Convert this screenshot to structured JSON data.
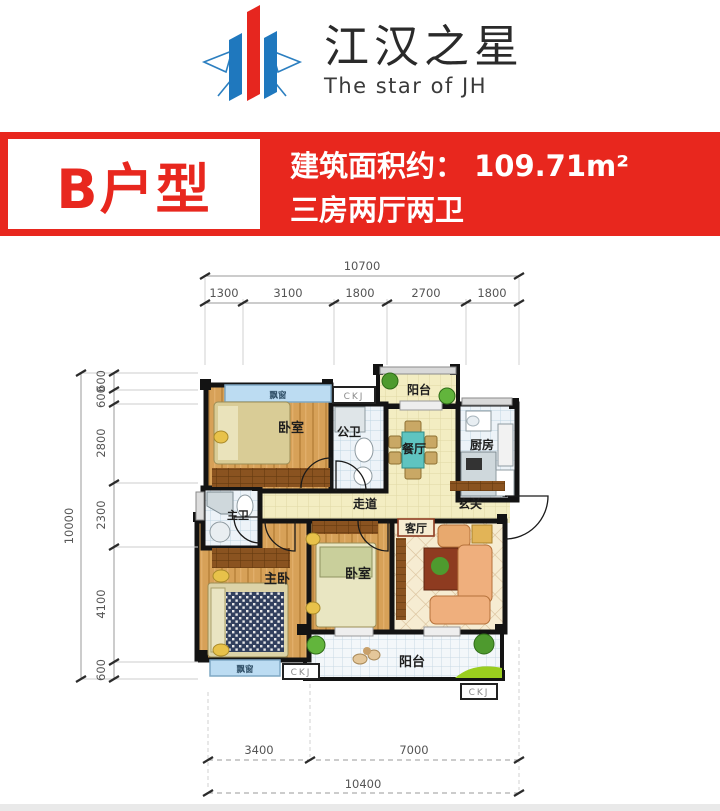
{
  "logo": {
    "name": "江汉之星",
    "subtitle": "The star of JH",
    "red": "#E6261F",
    "blue": "#1F78BE"
  },
  "banner": {
    "unit_label": "B户型",
    "area_text": "建筑面积约： 109.71m²",
    "layout_text": "三房两厅两卫",
    "bg_color": "#E8271E"
  },
  "plan": {
    "window_code": "CKJ",
    "rooms": {
      "balcony_top": "阳台",
      "bay_window_top": "飘窗",
      "bedroom_top": "卧室",
      "guest_bath": "公卫",
      "dining": "餐厅",
      "kitchen": "厨房",
      "foyer": "玄关",
      "corridor": "走道",
      "master_bath": "主卫",
      "master_bedroom": "主卧",
      "bedroom_bottom": "卧室",
      "living": "客厅",
      "balcony_bottom": "阳台",
      "bay_window_bottom": "飘窗"
    },
    "dims": {
      "top": {
        "total": "10700",
        "segments": [
          "1300",
          "3100",
          "1800",
          "2700",
          "1800"
        ]
      },
      "left": {
        "total": "10000",
        "segments": [
          "600",
          "600",
          "2800",
          "2300",
          "4100",
          "600"
        ]
      },
      "bottom": {
        "total": "10400",
        "segments": [
          "3400",
          "7000"
        ]
      }
    }
  }
}
